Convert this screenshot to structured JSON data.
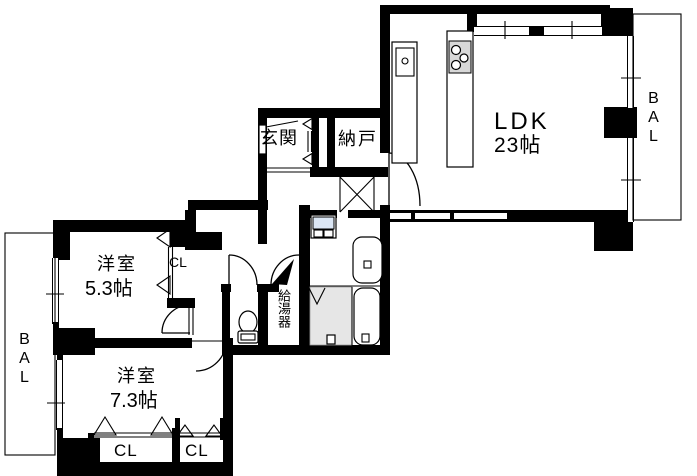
{
  "plan_title": "2LDK apartment floor plan",
  "rooms": {
    "ldk": {
      "name": "LDK",
      "size": "23帖"
    },
    "bedroom_53": {
      "name": "洋室",
      "size": "5.3帖"
    },
    "bedroom_73": {
      "name": "洋室",
      "size": "7.3帖"
    },
    "entrance": {
      "name": "玄関"
    },
    "storage": {
      "name": "納戸"
    },
    "water_heater": {
      "name": "給湯器"
    }
  },
  "closets": {
    "bedroom_53_closet": "CL",
    "bedroom_73_closet_left": "CL",
    "bedroom_73_closet_right": "CL"
  },
  "balconies": {
    "right": "BAL",
    "left": "BAL"
  },
  "colors": {
    "wall": "#000000",
    "bg": "#ffffff",
    "bath_floor": "#e6e6e6",
    "washer_pan": "#dbe6f4",
    "stove": "#d8d8d8"
  }
}
